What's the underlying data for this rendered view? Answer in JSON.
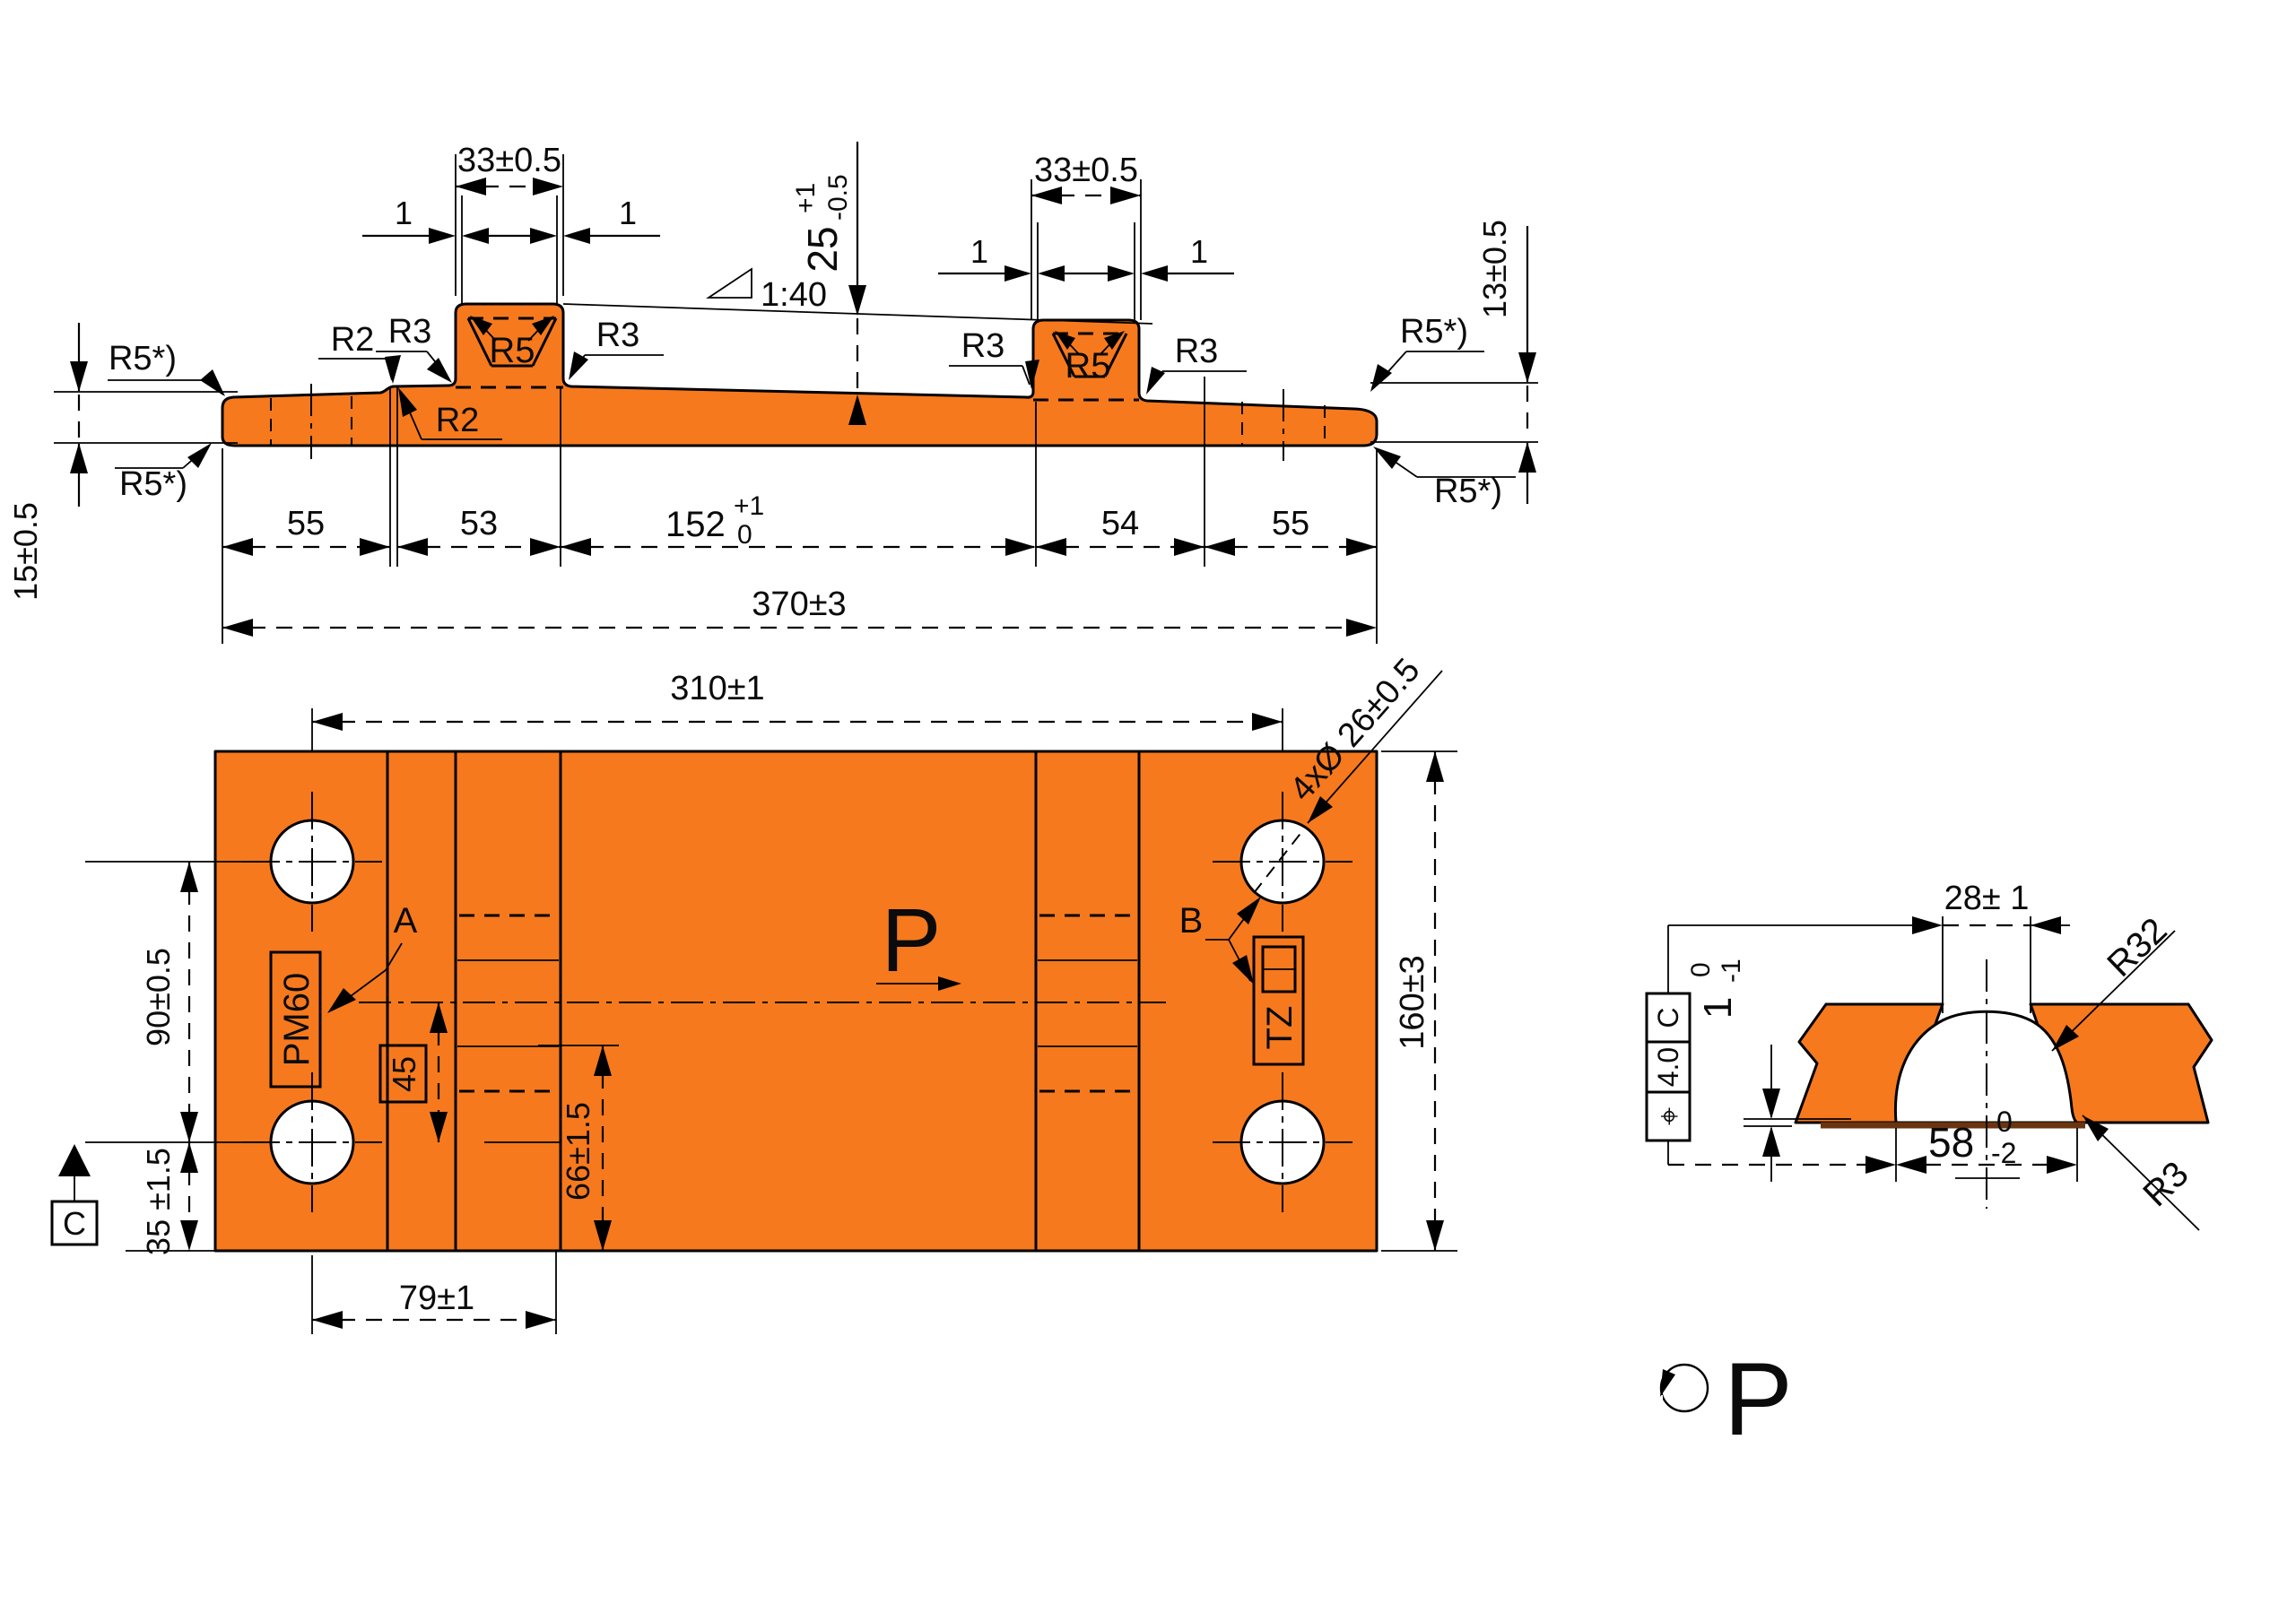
{
  "colors": {
    "part": "#F6791E",
    "lines": "#000000",
    "weld_root": "#6B3410",
    "background": "#ffffff"
  },
  "side_view": {
    "radii": {
      "top_left": "R5*)",
      "bottom_left": "R5*)",
      "top_right": "R5*)",
      "bottom_right": "R5*)",
      "step_upper": "R2",
      "step_lower": "R2",
      "boss_left": {
        "fillet_left": "R3",
        "fillet_right": "R3",
        "groove": "R5"
      },
      "boss_right": {
        "fillet_left": "R3",
        "fillet_right": "R3",
        "groove": "R5"
      }
    },
    "slope": "1:40",
    "boss_left": {
      "width": "33±0.5",
      "offset_left": "1",
      "offset_right": "1"
    },
    "boss_right": {
      "width": "33±0.5",
      "offset_left": "1",
      "offset_right": "1"
    },
    "height_boss": {
      "value": "25",
      "plus": "+1",
      "minus": "-0.5"
    },
    "thickness_left": "15±0.5",
    "thickness_right": "13±0.5",
    "lengths": {
      "a": "55",
      "b": "53",
      "c": {
        "value": "152",
        "plus": "+1",
        "minus": "0"
      },
      "d": "54",
      "e": "55",
      "total": "370±3"
    }
  },
  "plan_view": {
    "hole_spacing_x": "310±1",
    "hole_spacing_y": "90±0.5",
    "edge_offset": "35 ±1.5",
    "plate_width": "160±3",
    "holes": "4xØ 26±0.5",
    "groove_offset": "66±1.5",
    "boxed_45": "45",
    "hole_to_edge": "79±1",
    "stamp_a": "PM60",
    "stamp_b": "TZ",
    "label_a": "A",
    "label_b": "B",
    "datum": "C",
    "section_label": "P"
  },
  "detail_view": {
    "name": "P",
    "opening_width": "28± 1",
    "root_width": {
      "value": "58",
      "plus": "0",
      "minus": "-2"
    },
    "root_height": {
      "value": "1",
      "plus": "0",
      "minus": "-1"
    },
    "radius_dome": "R32",
    "radius_corner": "R3",
    "tolerance_frame": {
      "symbol": "⌖",
      "value": "4.0",
      "datum": "C"
    }
  }
}
